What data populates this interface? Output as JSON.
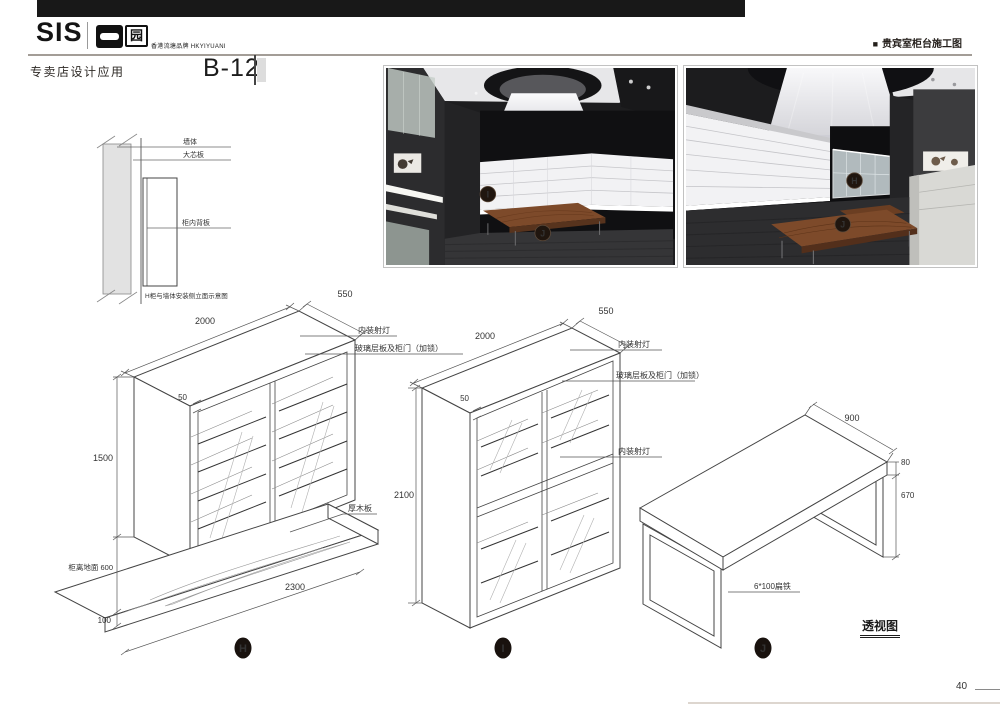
{
  "page": {
    "header": {
      "logo_text": "SIS",
      "logo_badge_char": "园",
      "logo_tagline": "香港流塘品牌 HKYIYUANI",
      "doc_title_bullet": "■",
      "doc_title": "贵宾室柜台施工图"
    },
    "subheader": {
      "section_title": "专卖店设计应用",
      "sheet_code": "B-12"
    },
    "footer": {
      "view_caption": "透视图",
      "page_number": "40"
    },
    "colors": {
      "ink": "#1a1a1a",
      "line": "#444444",
      "wood": "#7d4a2a"
    }
  },
  "photos": {
    "left": {
      "marker_shelf": "I",
      "marker_table": "J"
    },
    "right": {
      "marker_cabinet": "H",
      "marker_table": "J"
    }
  },
  "wall_detail": {
    "label_wall": "墙体",
    "label_core_board": "大芯板",
    "label_back_panel": "柜内背板",
    "caption": "H柜与墙体安装侧立面示意图"
  },
  "cabinet_h": {
    "marker": "H",
    "dim_width": "2000",
    "dim_depth": "550",
    "dim_frame": "50",
    "dim_height": "1500",
    "dim_floor_gap": "柜离地面 600",
    "dim_platform_height": "100",
    "dim_platform_length": "2300",
    "label_spotlight": "内装射灯",
    "label_glass_door": "玻璃层板及柜门（加锁）",
    "label_wood_board": "厚木板"
  },
  "cabinet_i": {
    "marker": "I",
    "dim_width": "2000",
    "dim_depth": "550",
    "dim_frame": "50",
    "dim_height": "2100",
    "label_spotlight_top": "内装射灯",
    "label_glass_door": "玻璃层板及柜门（加锁）",
    "label_spotlight_mid": "内装射灯"
  },
  "table_j": {
    "marker": "J",
    "dim_depth": "900",
    "dim_top_thickness": "80",
    "dim_leg_height": "670",
    "label_leg": "6*100扁铁"
  }
}
